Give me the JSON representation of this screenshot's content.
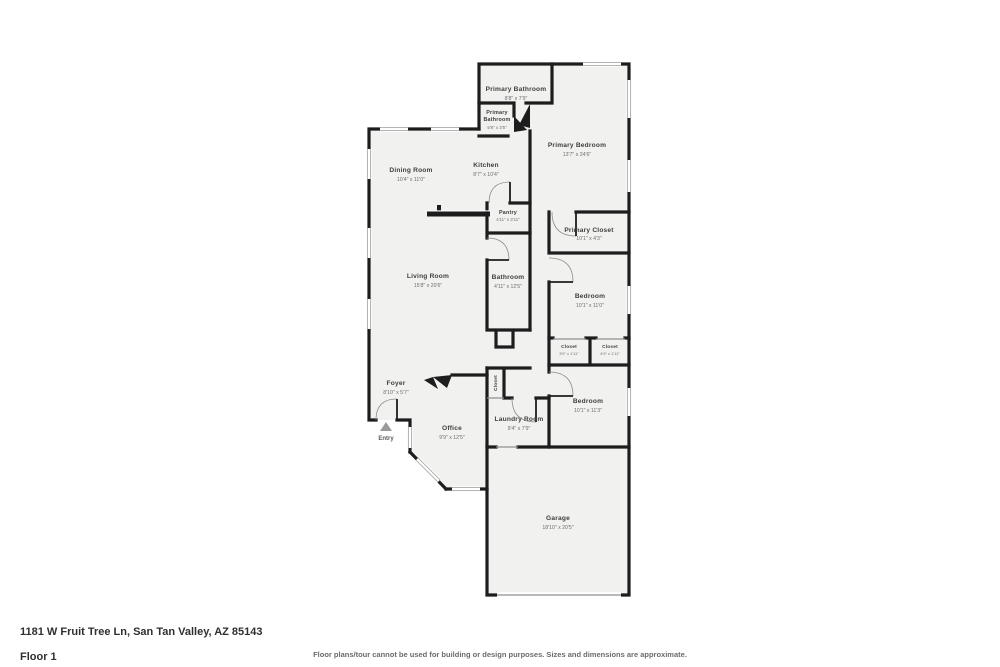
{
  "meta": {
    "address": "1181 W Fruit Tree Ln, San Tan Valley, AZ 85143",
    "floor_label": "Floor 1",
    "disclaimer": "Floor plans/tour cannot be used for building or design purposes. Sizes and dimensions are approximate."
  },
  "colors": {
    "wall": "#1d1d1d",
    "room_fill": "#f1f1f0",
    "bg": "#ffffff",
    "label": "#3f3f3f",
    "dims": "#6e6e6e"
  },
  "entry": {
    "label": "Entry",
    "marker": "triangle-up-icon"
  },
  "rooms": [
    {
      "name": "Primary Bathroom",
      "dims": "8'8\" x 7'9\""
    },
    {
      "name": "Primary Bathroom",
      "name_lines": [
        "Primary",
        "Bathroom"
      ],
      "dims": "5'8\" x 3'5\""
    },
    {
      "name": "Primary Bedroom",
      "dims": "13'7\" x 24'6\""
    },
    {
      "name": "Kitchen",
      "dims": "8'7\" x 10'4\""
    },
    {
      "name": "Dining Room",
      "dims": "10'4\" x 11'0\""
    },
    {
      "name": "Pantry",
      "dims": "4'11\" x 3'11\""
    },
    {
      "name": "Primary Closet",
      "dims": "10'1\" x 4'3\""
    },
    {
      "name": "Living Room",
      "dims": "15'8\" x 20'6\""
    },
    {
      "name": "Bathroom",
      "dims": "4'11\" x 12'5\""
    },
    {
      "name": "Bedroom",
      "dims": "10'1\" x 11'0\""
    },
    {
      "name": "Closet",
      "dims": "3'0\" x 1'11\""
    },
    {
      "name": "Closet",
      "dims": "4'9\" x 1'11\""
    },
    {
      "name": "Foyer",
      "dims": "8'10\" x 5'7\""
    },
    {
      "name": "Closet"
    },
    {
      "name": "Office",
      "dims": "9'9\" x 12'5\""
    },
    {
      "name": "Laundry Room",
      "dims": "9'4\" x 7'9\""
    },
    {
      "name": "Bedroom",
      "dims": "10'1\" x 11'3\""
    },
    {
      "name": "Garage",
      "dims": "18'10\" x 20'5\""
    }
  ]
}
